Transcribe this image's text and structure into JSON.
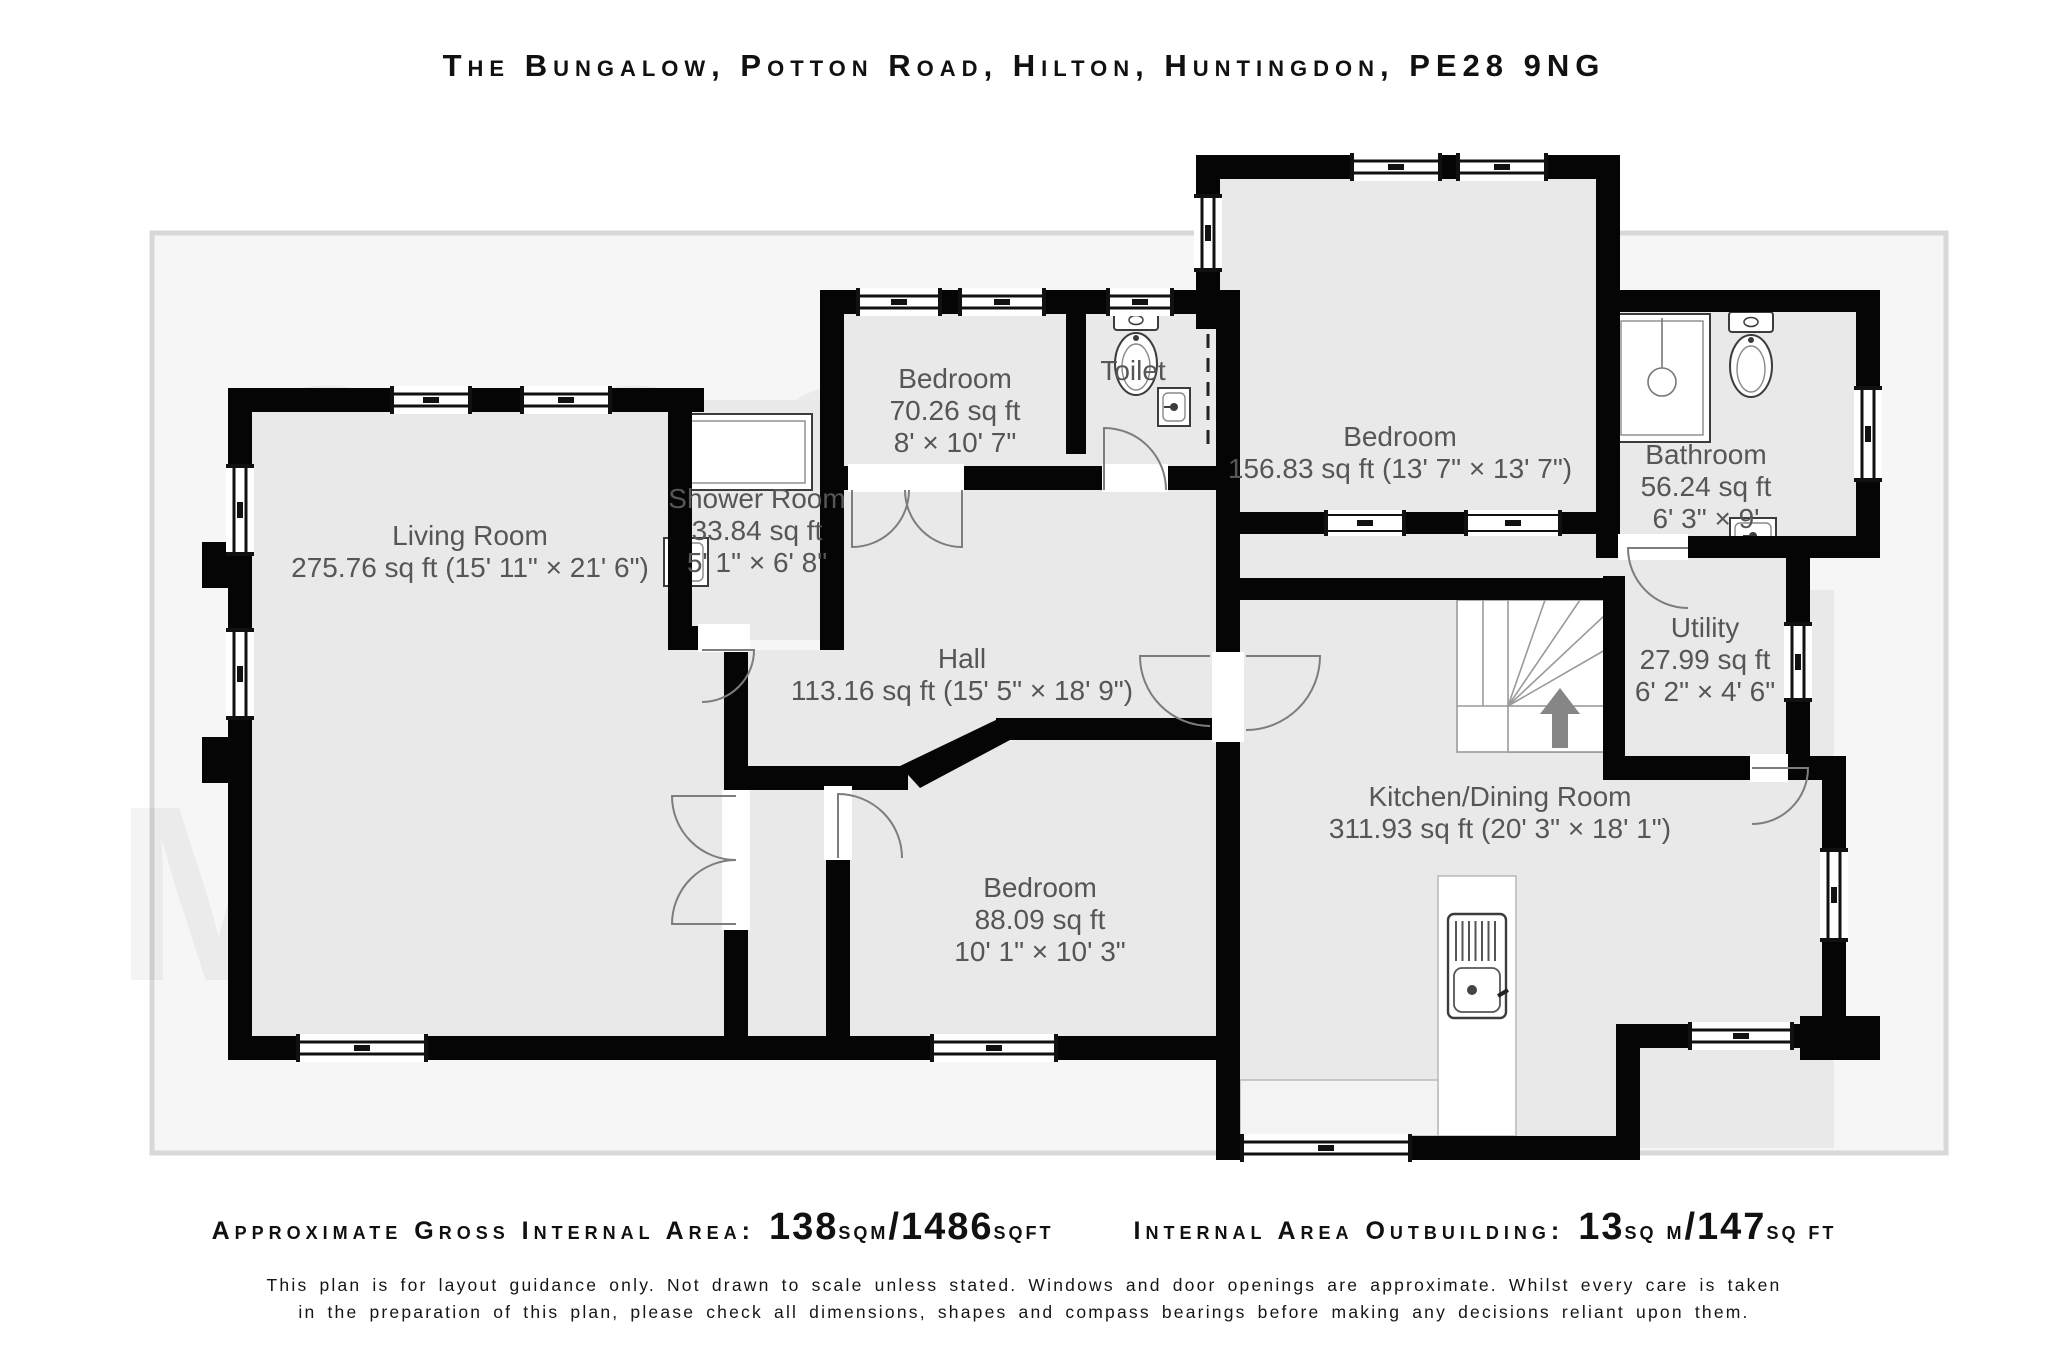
{
  "title": "The Bungalow, Potton Road, Hilton, Huntingdon, PE28 9NG",
  "watermark": [
    {
      "text": "GIGGS &",
      "x": 840,
      "y": 560
    },
    {
      "text": "McGRATH",
      "x": 800,
      "y": 980
    }
  ],
  "footer": {
    "gia": {
      "label": "Approximate Gross Internal Area:",
      "v1": "138",
      "u1": "sqm",
      "v2": "/1486",
      "u2": "sqft"
    },
    "outbuilding": {
      "label": "Internal Area Outbuilding:",
      "v1": "13",
      "u1": "sq m",
      "v2": "/147",
      "u2": "sq ft"
    },
    "disclaimer_line1": "This plan is for layout guidance only. Not drawn to scale unless stated. Windows and door openings are approximate. Whilst every care is taken",
    "disclaimer_line2": "in the preparation of this plan, please check all dimensions, shapes and compass bearings before making any decisions reliant upon them."
  },
  "rooms": [
    {
      "id": "living-room",
      "x": 470,
      "y": 545,
      "lines": [
        "Living Room",
        "275.76 sq ft (15' 11\" × 21' 6\")"
      ]
    },
    {
      "id": "shower-room",
      "x": 757,
      "y": 508,
      "lines": [
        "Shower Room",
        "33.84 sq ft",
        "5' 1\" × 6' 8\""
      ]
    },
    {
      "id": "bedroom-front",
      "x": 955,
      "y": 388,
      "lines": [
        "Bedroom",
        "70.26 sq ft",
        "8' × 10' 7\""
      ]
    },
    {
      "id": "toilet",
      "x": 1133,
      "y": 380,
      "lines": [
        "Toilet"
      ]
    },
    {
      "id": "bedroom-main",
      "x": 1400,
      "y": 446,
      "lines": [
        "Bedroom",
        "156.83 sq ft (13' 7\" × 13' 7\")"
      ]
    },
    {
      "id": "bathroom",
      "x": 1706,
      "y": 464,
      "lines": [
        "Bathroom",
        "56.24 sq ft",
        "6' 3\" × 9'"
      ]
    },
    {
      "id": "utility",
      "x": 1705,
      "y": 637,
      "lines": [
        "Utility",
        "27.99 sq ft",
        "6' 2\" × 4' 6\""
      ]
    },
    {
      "id": "hall",
      "x": 962,
      "y": 668,
      "lines": [
        "Hall",
        "113.16 sq ft (15' 5\" × 18' 9\")"
      ]
    },
    {
      "id": "kitchen-dining",
      "x": 1500,
      "y": 806,
      "lines": [
        "Kitchen/Dining Room",
        "311.93 sq ft (20' 3\" × 18' 1\")"
      ]
    },
    {
      "id": "bedroom-rear",
      "x": 1040,
      "y": 897,
      "lines": [
        "Bedroom",
        "88.09 sq ft",
        "10' 1\" × 10' 3\""
      ]
    }
  ],
  "plan": {
    "frame": {
      "x": 152,
      "y": 233,
      "w": 1794,
      "h": 920,
      "fill": "#f6f6f6",
      "stroke": "#d8d8d8"
    },
    "colors": {
      "wall": "#050505",
      "floor": "#e9e9e9",
      "label": "#565656",
      "arc": "#7d7d7d",
      "fixture": "#3c3c3c",
      "watermark": "rgba(0,0,0,0.045)",
      "arrow": "#868686"
    },
    "floors": [
      [
        240,
        400,
        496,
        648
      ],
      [
        680,
        400,
        150,
        240
      ],
      [
        832,
        302,
        246,
        176
      ],
      [
        1078,
        302,
        150,
        176
      ],
      [
        832,
        478,
        396,
        300
      ],
      [
        748,
        650,
        96,
        398
      ],
      [
        1208,
        167,
        400,
        357
      ],
      [
        1228,
        490,
        392,
        100
      ],
      [
        1608,
        302,
        260,
        246
      ],
      [
        1615,
        548,
        183,
        220
      ],
      [
        1228,
        590,
        606,
        558
      ],
      [
        838,
        730,
        390,
        318
      ]
    ],
    "walls": [
      [
        228,
        388,
        476,
        24
      ],
      [
        228,
        388,
        24,
        672
      ],
      [
        202,
        542,
        26,
        46
      ],
      [
        202,
        737,
        26,
        46
      ],
      [
        228,
        1036,
        1012,
        24
      ],
      [
        724,
        650,
        24,
        410
      ],
      [
        668,
        388,
        24,
        262
      ],
      [
        668,
        626,
        80,
        24
      ],
      [
        820,
        290,
        24,
        360
      ],
      [
        820,
        290,
        420,
        24
      ],
      [
        1066,
        290,
        20,
        164
      ],
      [
        1216,
        290,
        24,
        200
      ],
      [
        844,
        466,
        396,
        24
      ],
      [
        748,
        766,
        160,
        24
      ],
      [
        996,
        718,
        220,
        22
      ],
      [
        826,
        788,
        24,
        248
      ],
      [
        1216,
        466,
        24,
        186
      ],
      [
        1216,
        740,
        24,
        420
      ],
      [
        1196,
        155,
        24,
        174
      ],
      [
        1196,
        155,
        424,
        24
      ],
      [
        1596,
        155,
        24,
        157
      ],
      [
        1240,
        512,
        380,
        22
      ],
      [
        1216,
        578,
        402,
        22
      ],
      [
        1596,
        290,
        284,
        22
      ],
      [
        1856,
        290,
        24,
        268
      ],
      [
        1596,
        300,
        24,
        258
      ],
      [
        1620,
        536,
        260,
        22
      ],
      [
        1786,
        536,
        24,
        244
      ],
      [
        1603,
        576,
        22,
        204
      ],
      [
        1603,
        756,
        207,
        24
      ],
      [
        1786,
        756,
        60,
        24
      ],
      [
        1822,
        756,
        24,
        284
      ],
      [
        1800,
        1016,
        80,
        44
      ],
      [
        1636,
        1024,
        190,
        24
      ],
      [
        1616,
        1024,
        24,
        136
      ],
      [
        1216,
        1136,
        424,
        24
      ]
    ],
    "wall_polys": [
      [
        [
          900,
          766
        ],
        [
          1000,
          718
        ],
        [
          1010,
          740
        ],
        [
          920,
          788
        ]
      ]
    ],
    "openings": [
      [
        848,
        464,
        116,
        28
      ],
      [
        1102,
        464,
        66,
        28
      ],
      [
        722,
        790,
        28,
        140
      ],
      [
        698,
        624,
        52,
        28
      ],
      [
        1618,
        534,
        70,
        26
      ],
      [
        1750,
        754,
        38,
        28
      ],
      [
        824,
        786,
        28,
        74
      ],
      [
        1212,
        652,
        32,
        90
      ]
    ],
    "windows": [
      {
        "x": 390,
        "y": 386,
        "w": 82,
        "h": 28,
        "o": "h",
        "s": "ext"
      },
      {
        "x": 520,
        "y": 386,
        "w": 92,
        "h": 28,
        "o": "h",
        "s": "ext"
      },
      {
        "x": 226,
        "y": 464,
        "w": 28,
        "h": 92,
        "o": "v",
        "s": "ext"
      },
      {
        "x": 226,
        "y": 628,
        "w": 28,
        "h": 92,
        "o": "v",
        "s": "ext"
      },
      {
        "x": 296,
        "y": 1034,
        "w": 132,
        "h": 28,
        "o": "h",
        "s": "ext"
      },
      {
        "x": 856,
        "y": 288,
        "w": 86,
        "h": 28,
        "o": "h",
        "s": "ext"
      },
      {
        "x": 958,
        "y": 288,
        "w": 88,
        "h": 28,
        "o": "h",
        "s": "ext"
      },
      {
        "x": 1106,
        "y": 288,
        "w": 68,
        "h": 28,
        "o": "h",
        "s": "ext"
      },
      {
        "x": 1350,
        "y": 153,
        "w": 92,
        "h": 28,
        "o": "h",
        "s": "ext"
      },
      {
        "x": 1456,
        "y": 153,
        "w": 92,
        "h": 28,
        "o": "h",
        "s": "ext"
      },
      {
        "x": 1194,
        "y": 194,
        "w": 28,
        "h": 78,
        "o": "v",
        "s": "ext"
      },
      {
        "x": 1854,
        "y": 386,
        "w": 28,
        "h": 96,
        "o": "v",
        "s": "ext"
      },
      {
        "x": 1784,
        "y": 622,
        "w": 28,
        "h": 80,
        "o": "v",
        "s": "ext"
      },
      {
        "x": 1820,
        "y": 848,
        "w": 28,
        "h": 94,
        "o": "v",
        "s": "ext"
      },
      {
        "x": 1688,
        "y": 1022,
        "w": 106,
        "h": 28,
        "o": "h",
        "s": "ext"
      },
      {
        "x": 1240,
        "y": 1134,
        "w": 172,
        "h": 28,
        "o": "h",
        "s": "ext"
      },
      {
        "x": 930,
        "y": 1034,
        "w": 128,
        "h": 28,
        "o": "h",
        "s": "ext"
      },
      {
        "x": 1324,
        "y": 510,
        "w": 82,
        "h": 26,
        "o": "h",
        "s": "int"
      },
      {
        "x": 1464,
        "y": 510,
        "w": 98,
        "h": 26,
        "o": "h",
        "s": "int"
      }
    ],
    "dashes": [
      [
        1208,
        334,
        1208,
        446
      ]
    ],
    "doors": [
      {
        "hx": 852,
        "hy": 490,
        "r": 57,
        "a0": 90,
        "a1": 0,
        "s": 0
      },
      {
        "hx": 962,
        "hy": 490,
        "r": 57,
        "a0": 90,
        "a1": 180,
        "s": 1
      },
      {
        "hx": 1104,
        "hy": 490,
        "r": 62,
        "a0": -90,
        "a1": 0,
        "s": 1
      },
      {
        "hx": 736,
        "hy": 796,
        "r": 64,
        "a0": 180,
        "a1": 90,
        "s": 0
      },
      {
        "hx": 736,
        "hy": 924,
        "r": 64,
        "a0": 180,
        "a1": 270,
        "s": 1
      },
      {
        "hx": 1210,
        "hy": 656,
        "r": 70,
        "a0": 180,
        "a1": 90,
        "s": 0
      },
      {
        "hx": 1246,
        "hy": 656,
        "r": 74,
        "a0": 0,
        "a1": 90,
        "s": 1
      },
      {
        "hx": 1688,
        "hy": 548,
        "r": 60,
        "a0": 180,
        "a1": 90,
        "s": 0
      },
      {
        "hx": 1752,
        "hy": 768,
        "r": 56,
        "a0": 0,
        "a1": 90,
        "s": 1
      },
      {
        "hx": 702,
        "hy": 650,
        "r": 52,
        "a0": 0,
        "a1": 90,
        "s": 1
      },
      {
        "hx": 838,
        "hy": 858,
        "r": 64,
        "a0": -90,
        "a1": 0,
        "s": 1
      }
    ],
    "stairs": {
      "frame": [
        1457,
        600,
        148,
        152
      ],
      "treadX": [
        1483,
        1508
      ],
      "treadY": [
        600,
        706
      ],
      "pivot": [
        1508,
        706
      ],
      "fan": [
        [
          1545,
          600
        ],
        [
          1580,
          600
        ],
        [
          1605,
          615
        ],
        [
          1605,
          650
        ]
      ],
      "landing": [
        1508,
        706,
        97,
        46
      ],
      "arrow": {
        "x": 1560,
        "tip": 688,
        "base": 714,
        "bottom": 748,
        "hw": 20,
        "sw": 8
      }
    },
    "fixtures": [
      {
        "t": "tray",
        "x": 676,
        "y": 414,
        "w": 136,
        "h": 76
      },
      {
        "t": "tray",
        "x": 1614,
        "y": 314,
        "w": 96,
        "h": 128,
        "drain": [
          1662,
          382
        ]
      },
      {
        "t": "toilet",
        "cx": 1136,
        "top": 310
      },
      {
        "t": "toilet",
        "cx": 1751,
        "top": 312
      },
      {
        "t": "sink",
        "x": 1158,
        "y": 388,
        "w": 32,
        "h": 38
      },
      {
        "t": "sink",
        "x": 664,
        "y": 538,
        "w": 44,
        "h": 48
      },
      {
        "t": "sink",
        "x": 1730,
        "y": 518,
        "w": 46,
        "h": 36
      },
      {
        "t": "counter",
        "x": 1438,
        "y": 876,
        "w": 78,
        "h": 260,
        "fill": "#ffffff"
      },
      {
        "t": "counter",
        "x": 1240,
        "y": 1080,
        "w": 198,
        "h": 56,
        "fill": "#f3f3f3"
      },
      {
        "t": "ksink",
        "x": 1448,
        "y": 914
      }
    ]
  }
}
